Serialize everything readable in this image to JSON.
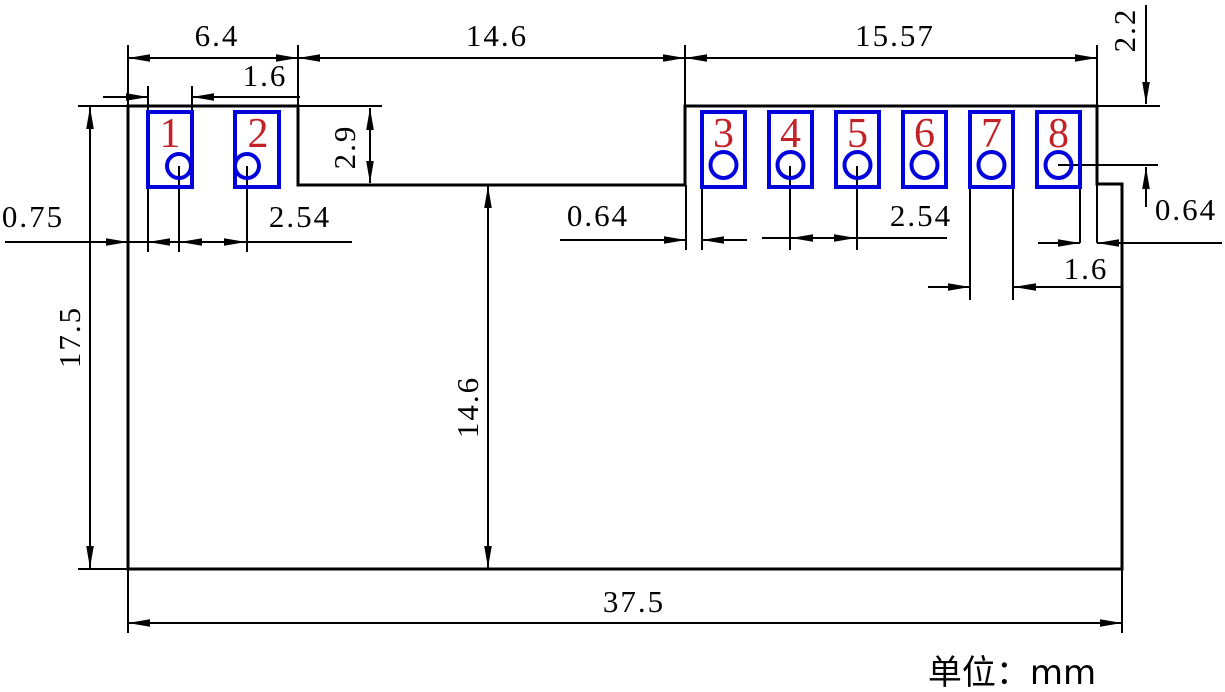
{
  "drawing": {
    "units_note": "单位：mm",
    "pad_numbers": [
      "1",
      "2",
      "3",
      "4",
      "5",
      "6",
      "7",
      "8"
    ],
    "dimensions": {
      "left_block_width": "6.4",
      "center_gap_width": "14.6",
      "right_block_width": "15.57",
      "pad1_width": "1.6",
      "notch_depth": "2.9",
      "hole_row_offset": "2.2",
      "overall_height": "17.5",
      "body_height": "14.6",
      "left_edge_to_pad1": "0.75",
      "left_pad_pitch": "2.54",
      "gap_to_pad3": "0.64",
      "right_pad_pitch": "2.54",
      "pad8_to_edge": "0.64",
      "pad7_width": "1.6",
      "overall_width": "37.5"
    },
    "colors": {
      "line": "#000000",
      "pad_outline": "#0202dd",
      "pad_number": "#c22126"
    }
  }
}
